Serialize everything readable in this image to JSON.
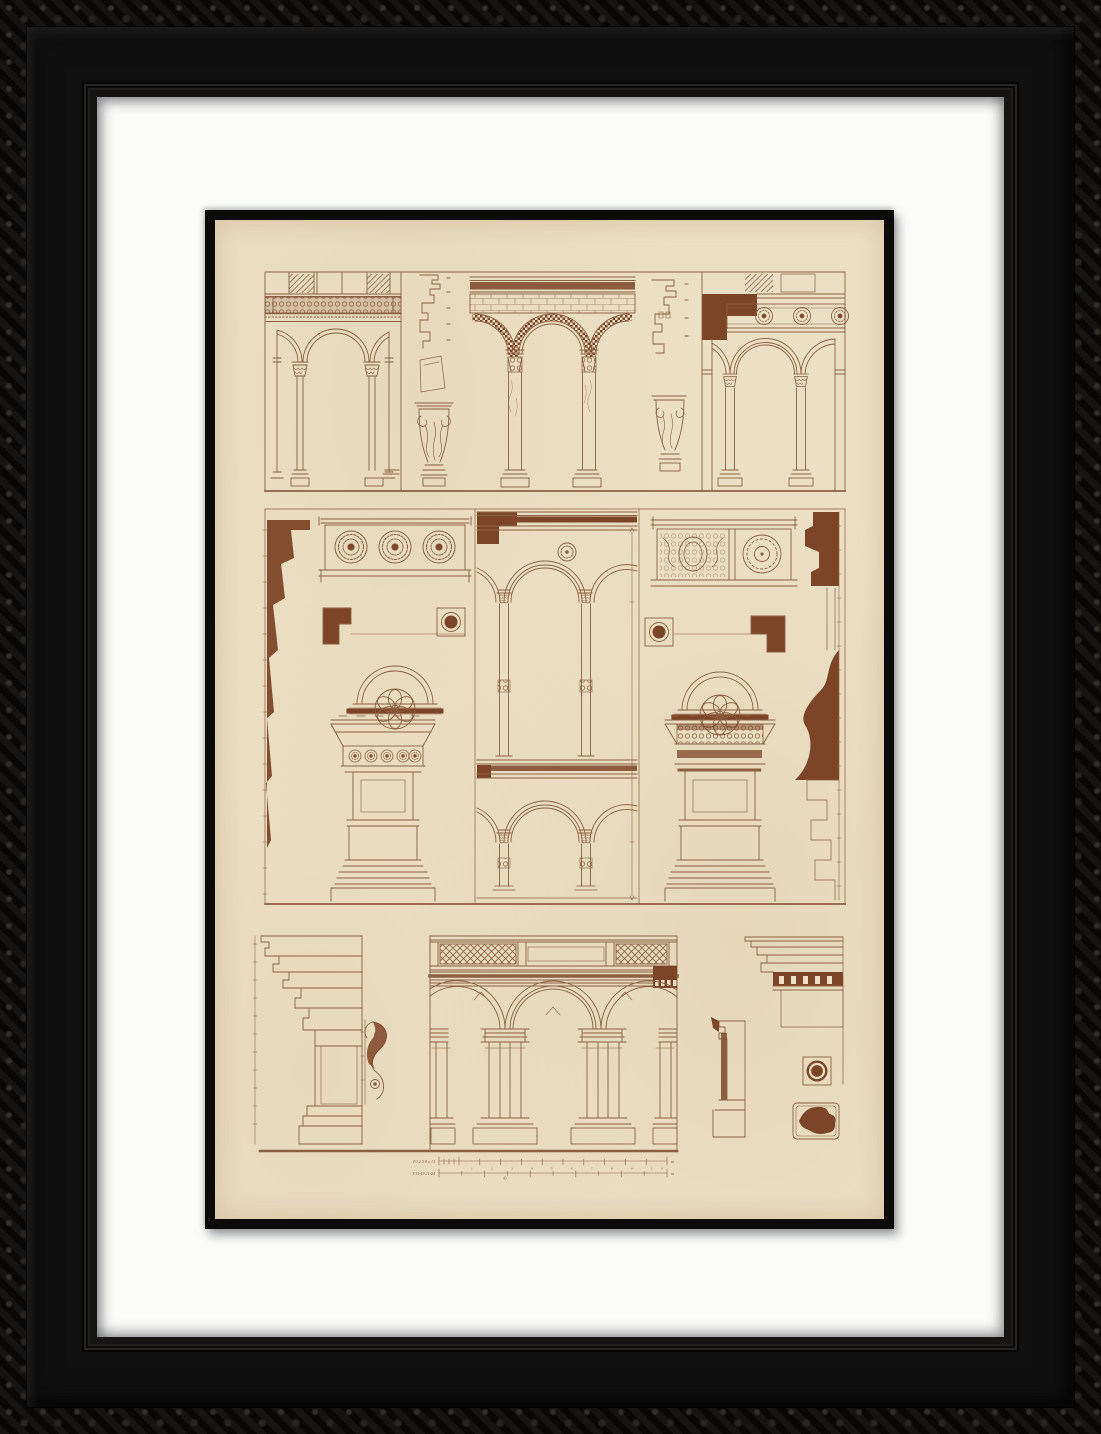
{
  "artwork": {
    "kind": "Framed sepia architectural plate of Renaissance palace arcades, columns and mouldings",
    "colors": {
      "frame": "#0c0b0a",
      "mat": "#fbfbf8",
      "printborder": "#0d0b09",
      "paper": "#ece0c4",
      "ink": "#8d5f41",
      "poche": "#7d4527"
    }
  },
  "plate": {
    "scale_bars": [
      {
        "label": "F.1.2.5.8 u.13",
        "ticks": "1 2 3 4 5 6 7 8 9 10",
        "unit": "m"
      },
      {
        "label": "F.11-19.21-24",
        "ticks": "5 10 15 20",
        "unit": "m",
        "annotation": "43"
      }
    ]
  }
}
